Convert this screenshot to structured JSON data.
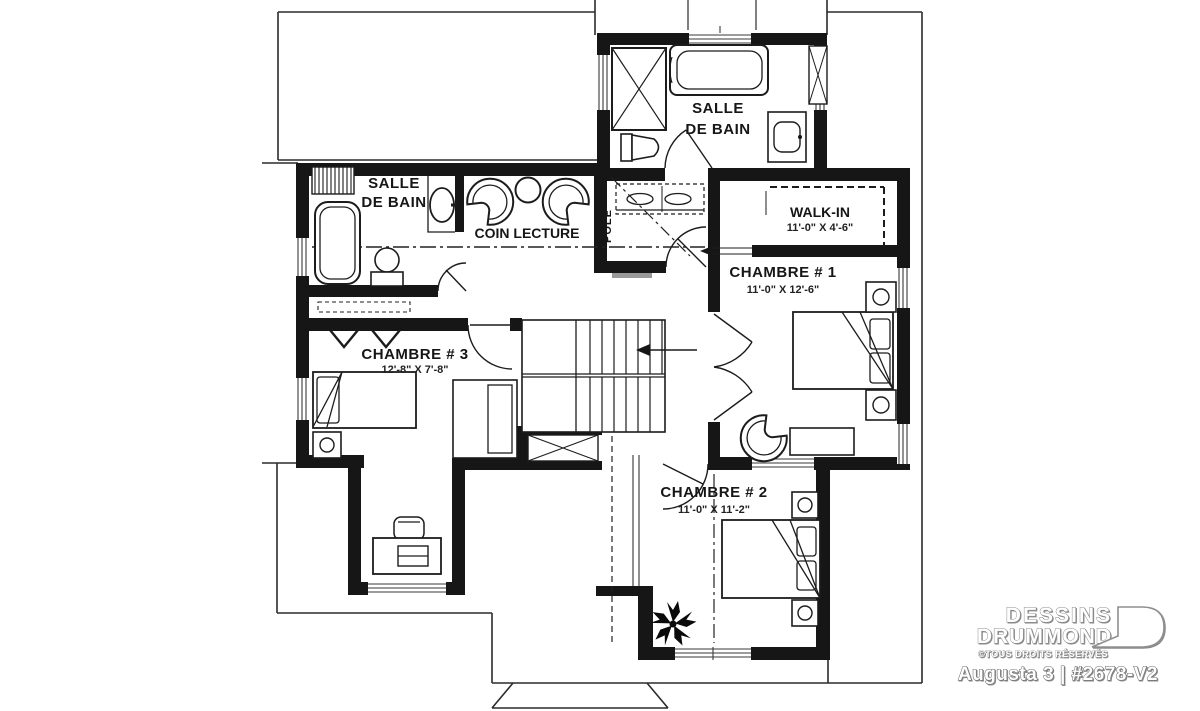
{
  "colors": {
    "wall": "#161616",
    "line": "#1c1c1c",
    "roofline": "#2b2b2b",
    "background": "#ffffff",
    "gray_sill": "#999999"
  },
  "plan": {
    "floor_type": "floor-plan-second-level",
    "rooms": {
      "bathroom_top": {
        "label_line1": "SALLE",
        "label_line2": "DE BAIN"
      },
      "bathroom_left": {
        "label_line1": "SALLE",
        "label_line2": "DE BAIN"
      },
      "reading_nook": {
        "label": "COIN LECTURE"
      },
      "closet": {
        "label": "PÔLE"
      },
      "walk_in": {
        "label": "WALK-IN",
        "dimensions": "11'-0\" X 4'-6\""
      },
      "bedroom_1": {
        "label": "CHAMBRE # 1",
        "dimensions": "11'-0\" X 12'-6\""
      },
      "bedroom_2": {
        "label": "CHAMBRE # 2",
        "dimensions": "11'-0\" X 11'-2\""
      },
      "bedroom_3": {
        "label": "CHAMBRE # 3",
        "dimensions": "12'-8\" X 7'-8\""
      }
    }
  },
  "branding": {
    "company_line1": "DESSINS",
    "company_line2": "DRUMMOND",
    "rights_notice": "©TOUS DROITS RÉSERVÉS",
    "plan_title": "Augusta 3 | #2678-V2"
  }
}
